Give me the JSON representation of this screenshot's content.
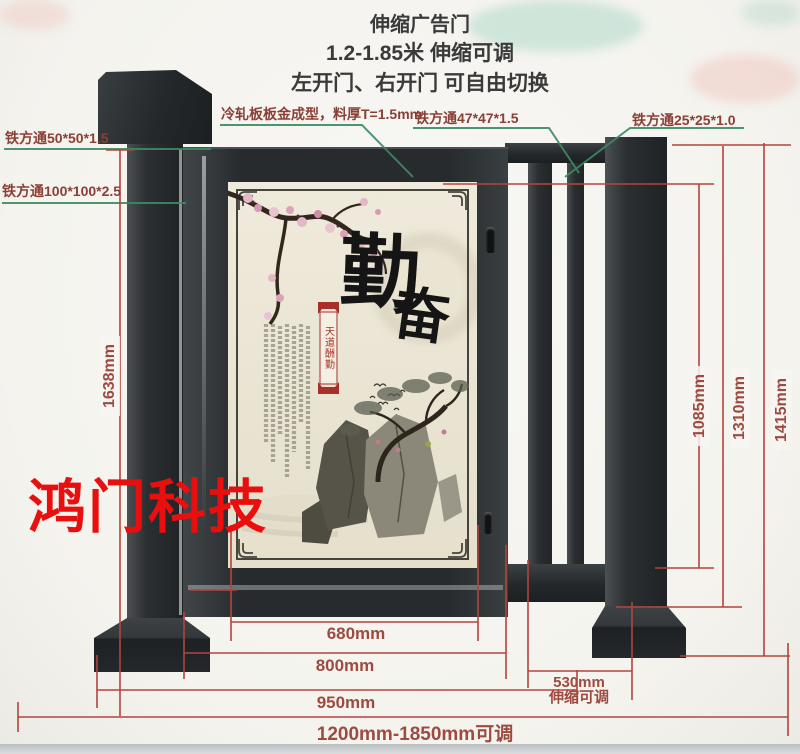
{
  "header": {
    "title": "伸缩广告门",
    "subtitle": "1.2-1.85米 伸缩可调",
    "note": "左开门、右开门 可自由切换"
  },
  "callouts": {
    "tube_50": "铁方通50*50*1.5",
    "tube_100": "铁方通100*100*2.5",
    "panel_material": "冷轧板板金成型，料厚T=1.5mm",
    "tube_47": "铁方通47*47*1.5",
    "tube_25": "铁方通25*25*1.0"
  },
  "dimensions": {
    "left_height": "1638mm",
    "inner_height": "1085mm",
    "mid_height": "1310mm",
    "outer_height": "1415mm",
    "panel_width": "680mm",
    "door_width": "800mm",
    "span_width": "950mm",
    "extension_width": "530mm",
    "extension_note": "伸缩可调",
    "total_width": "1200mm-1850mm可调"
  },
  "poster": {
    "calligraphy_char_1": "勤",
    "calligraphy_char_2": "奋",
    "seal_banner": "天道酬勤"
  },
  "watermark": "鸿门科技",
  "colors": {
    "dimension_line": "#b2453d",
    "callout_line": "#3d8a63",
    "label_text": "#8a4036",
    "watermark_red": "#e90f0f",
    "gate_dark": "#2b2f31",
    "poster_bg": "#ece7d8"
  }
}
